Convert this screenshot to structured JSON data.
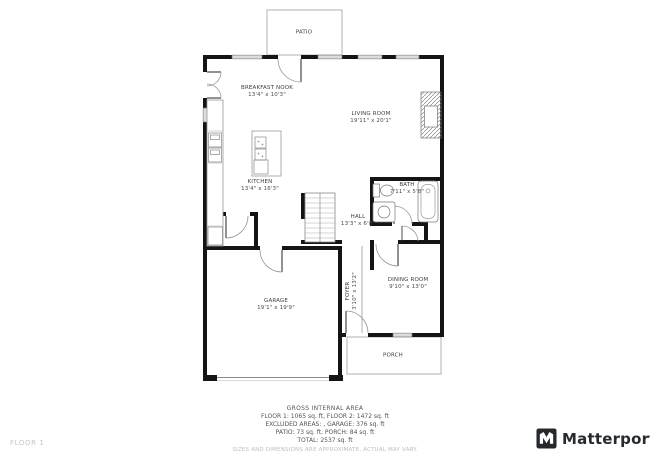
{
  "page": {
    "floor_label": "FLOOR 1"
  },
  "branding": {
    "name": "Matterport"
  },
  "rooms": {
    "patio": {
      "name": "PATIO"
    },
    "breakfast_nook": {
      "name": "BREAKFAST NOOK",
      "dims": "13'4\" x 10'3\""
    },
    "living_room": {
      "name": "LIVING ROOM",
      "dims": "19'11\" x 20'1\""
    },
    "kitchen": {
      "name": "KITCHEN",
      "dims": "13'4\" x 16'3\""
    },
    "bath": {
      "name": "BATH",
      "dims": "7'11\" x 5'8\""
    },
    "hall": {
      "name": "HALL",
      "dims": "13'3\" x 6'8\""
    },
    "dining_room": {
      "name": "DINING ROOM",
      "dims": "9'10\" x 13'0\""
    },
    "foyer": {
      "name": "FOYER",
      "dims": "3'10\" x 13'2\""
    },
    "garage": {
      "name": "GARAGE",
      "dims": "19'1\" x 19'9\""
    },
    "porch": {
      "name": "PORCH"
    }
  },
  "summary": {
    "title": "GROSS INTERNAL AREA",
    "line1": "FLOOR 1: 1065 sq. ft, FLOOR 2: 1472 sq. ft",
    "line2": "EXCLUDED AREAS: , GARAGE: 376 sq. ft",
    "line3": "PATIO: 73 sq. ft, PORCH: 84 sq. ft",
    "line4": "TOTAL: 2537 sq. ft",
    "disclaimer": "SIZES AND DIMENSIONS ARE APPROXIMATE, ACTUAL MAY VARY."
  },
  "colors": {
    "wall": "#141414",
    "thin_line": "#8a8a8a",
    "label_text": "#3d3d3d",
    "muted_text": "#bdbdbd",
    "summary_text": "#555555"
  }
}
